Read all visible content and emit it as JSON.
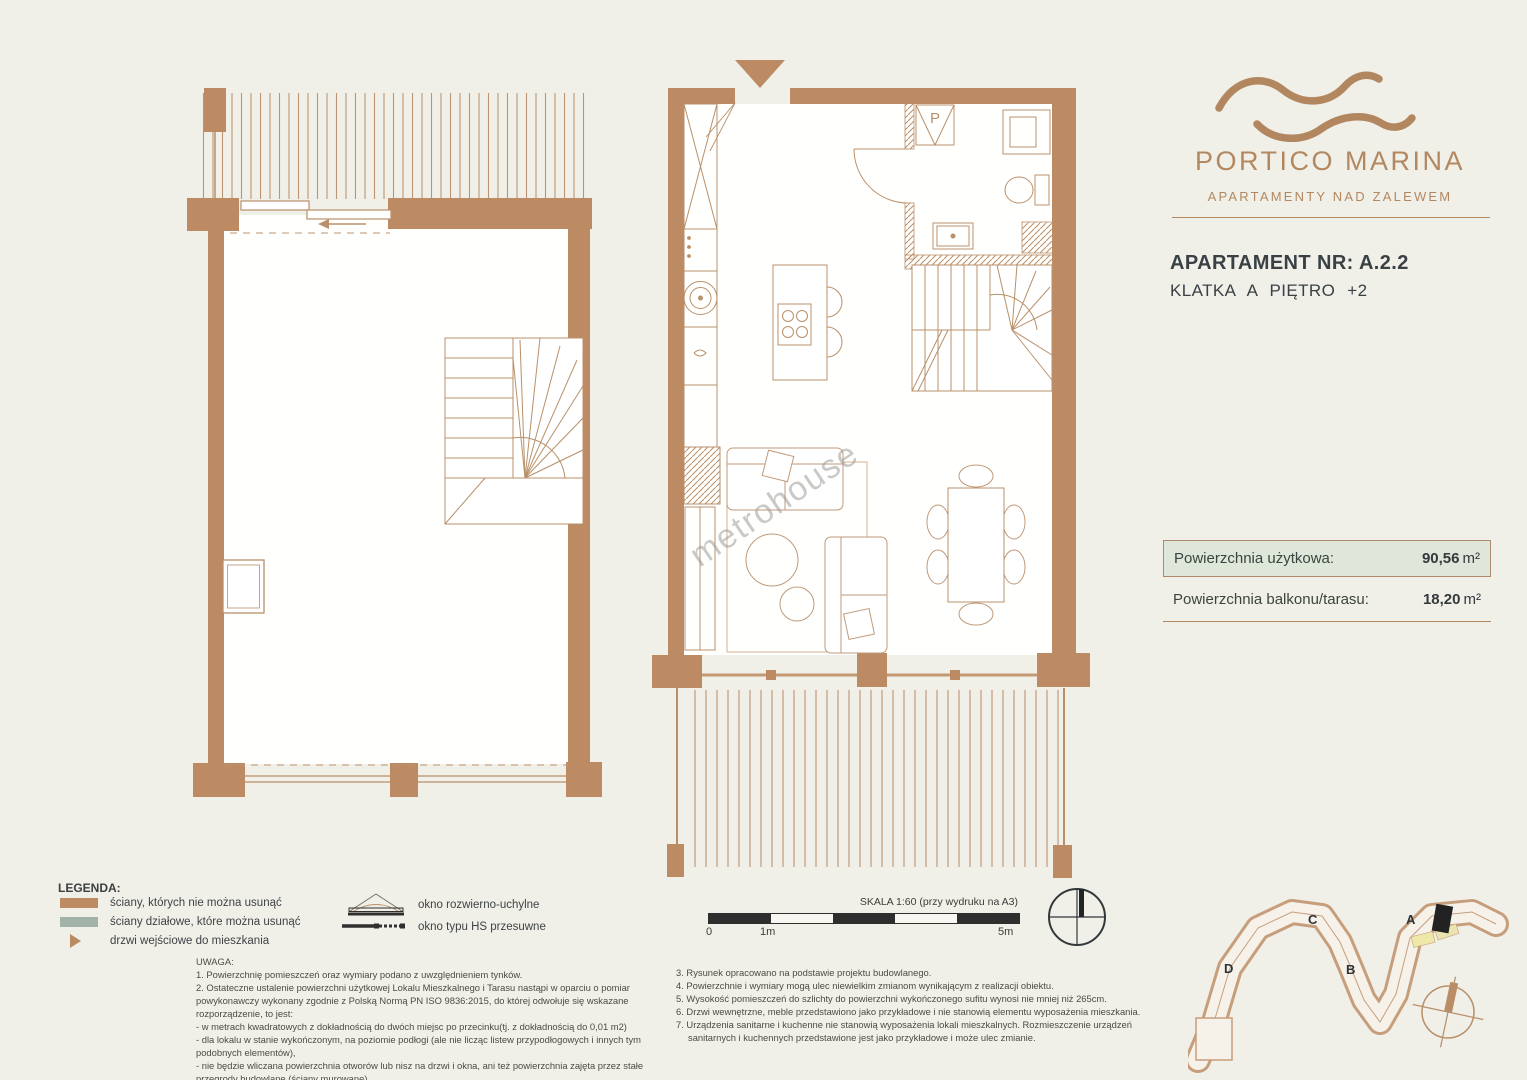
{
  "brand": {
    "name": "PORTICO MARINA",
    "tagline": "APARTAMENTY NAD ZALEWEM"
  },
  "apartment": {
    "number_line": "APARTAMENT NR: A.2.2",
    "location_line": "KLATKA A PIĘTRO +2"
  },
  "areas": {
    "usable_label": "Powierzchnia użytkowa:",
    "usable_value": "90,56",
    "balcony_label": "Powierzchnia balkonu/tarasu:",
    "balcony_value": "18,20",
    "unit": "m²"
  },
  "legend": {
    "title": "LEGENDA:",
    "items": [
      "ściany, których nie można usunąć",
      "ściany działowe, które można usunąć",
      "drzwi wejściowe do mieszkania"
    ]
  },
  "window_legend": {
    "items": [
      "okno rozwierno-uchylne",
      "okno typu HS przesuwne"
    ]
  },
  "notes": {
    "title": "UWAGA:",
    "left": [
      "1. Powierzchnię pomieszczeń oraz wymiary podano z uwzględnieniem tynków.",
      "2. Ostateczne  ustalenie powierzchni użytkowej Lokalu Mieszkalnego i Tarasu  nastąpi w oparciu o pomiar powykonawczy wykonany zgodnie z Polską Normą PN ISO 9836:2015, do której odwołuje się wskazane rozporządzenie, to jest:",
      "- w metrach kwadratowych z dokładnością do dwóch miejsc po przecinku(tj. z dokładnością do 0,01 m2)",
      "- dla lokalu w stanie wykończonym, na poziomie podłogi (ale nie licząc listew przypodłogowych i innych tym podobnych elementów),",
      "- nie będzie wliczana powierzchnia otworów lub nisz na drzwi i okna, ani też powierzchnia zajęta przez stałe przegrody budowlane (ściany murowane)."
    ],
    "right": [
      "3. Rysunek opracowano na podstawie projektu budowlanego.",
      "4. Powierzchnie i wymiary mogą ulec niewielkim zmianom wynikającym z realizacji obiektu.",
      "5. Wysokość pomieszczeń do szlichty do powierzchni wykończonego sufitu wynosi nie mniej niż 265cm.",
      "6. Drzwi wewnętrzne, meble przedstawiono jako przykładowe i nie stanowią elementu wyposażenia mieszkania.",
      "7. Urządzenia sanitarne i kuchenne nie stanowią wyposażenia lokali mieszkalnych. Rozmieszczenie urządzeń sanitarnych i kuchennych przedstawione jest jako przykładowe i może ulec zmianie."
    ]
  },
  "scale": {
    "label": "SKALA 1:60 (przy wydruku na A3)",
    "ticks": [
      "0",
      "1m",
      "5m"
    ]
  },
  "site_plan": {
    "labels": [
      "D",
      "C",
      "B",
      "A"
    ]
  },
  "plan": {
    "bathroom_label": "P"
  },
  "watermark": "metrohouse",
  "colors": {
    "wall": "#bc8a63",
    "line": "#b8906a",
    "sage": "#a3b2a8",
    "accent": "#b38860",
    "highlight_box": "#dfe7da",
    "unit_marker_black": "#222222"
  }
}
